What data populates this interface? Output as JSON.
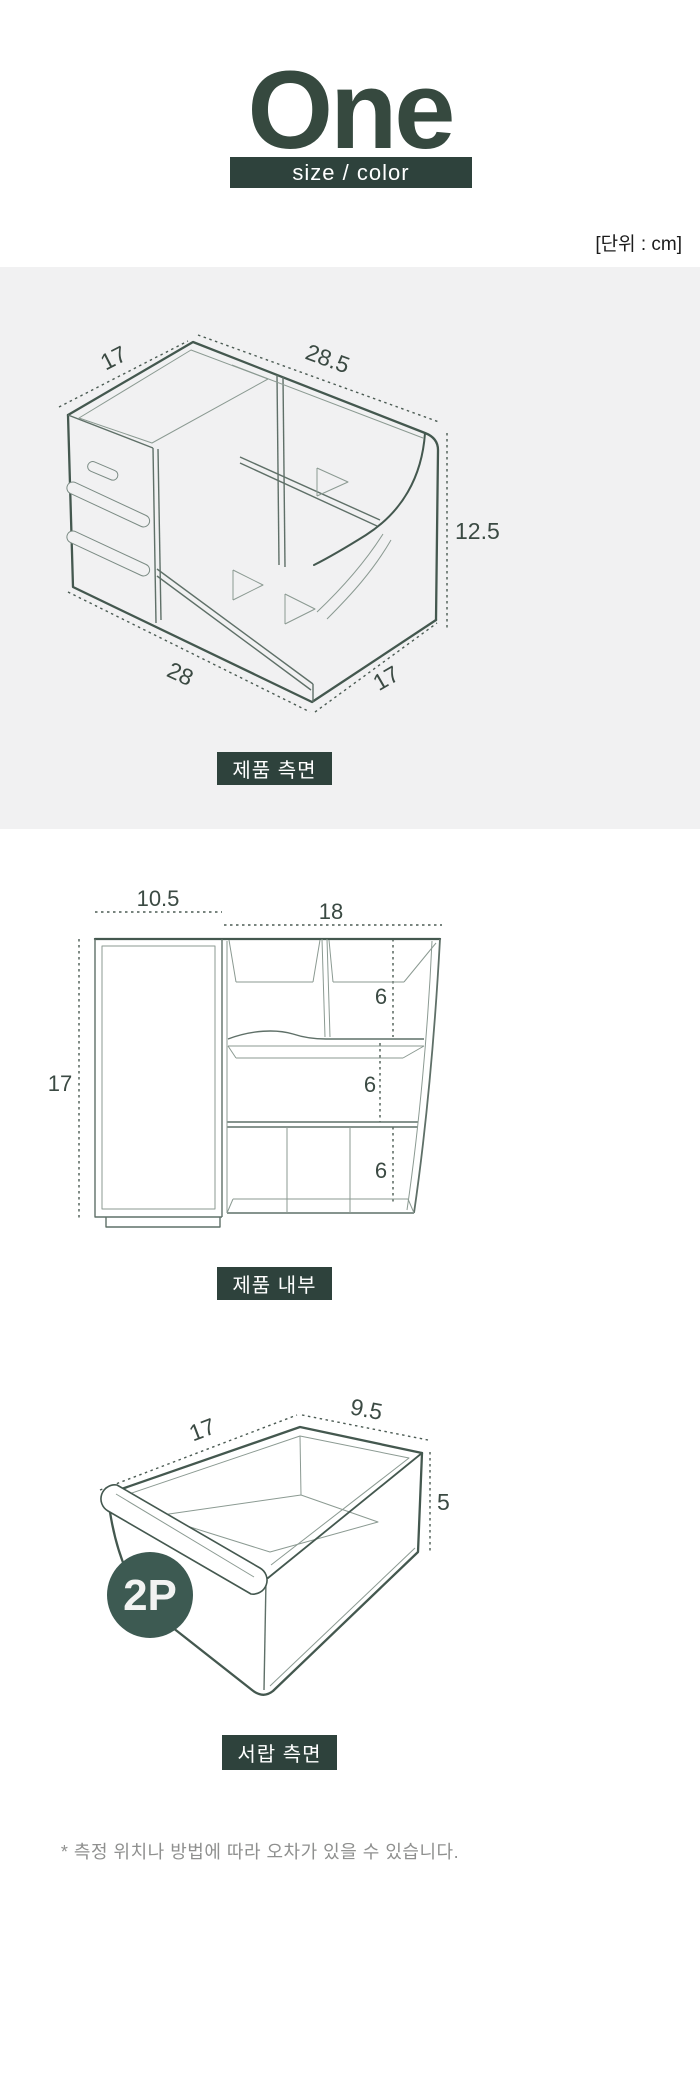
{
  "header": {
    "title": "One",
    "subtitle": "size / color",
    "unit_note": "[단위 : cm]"
  },
  "colors": {
    "brand_dark_green": "#2e423c",
    "title_green": "#36493f",
    "badge_green": "#3d5a52",
    "panel_gray": "#f1f1f2",
    "line_art": "#44584f",
    "dim_text": "#3b4a43",
    "footnote_gray": "#8f908f"
  },
  "diagram_side": {
    "caption": "제품 측면",
    "dims": {
      "top_depth": "17",
      "top_width": "28.5",
      "height": "12.5",
      "bottom_width": "28",
      "bottom_depth": "17"
    }
  },
  "diagram_inner": {
    "caption": "제품 내부",
    "dims": {
      "left_width": "10.5",
      "right_width": "18",
      "height": "17",
      "pocket_top": "6",
      "pocket_mid": "6",
      "pocket_bottom": "6"
    }
  },
  "diagram_drawer": {
    "caption": "서랍 측면",
    "badge": "2P",
    "dims": {
      "depth": "17",
      "width": "9.5",
      "height": "5"
    }
  },
  "footnote": "* 측정 위치나 방법에 따라 오차가 있을 수 있습니다."
}
